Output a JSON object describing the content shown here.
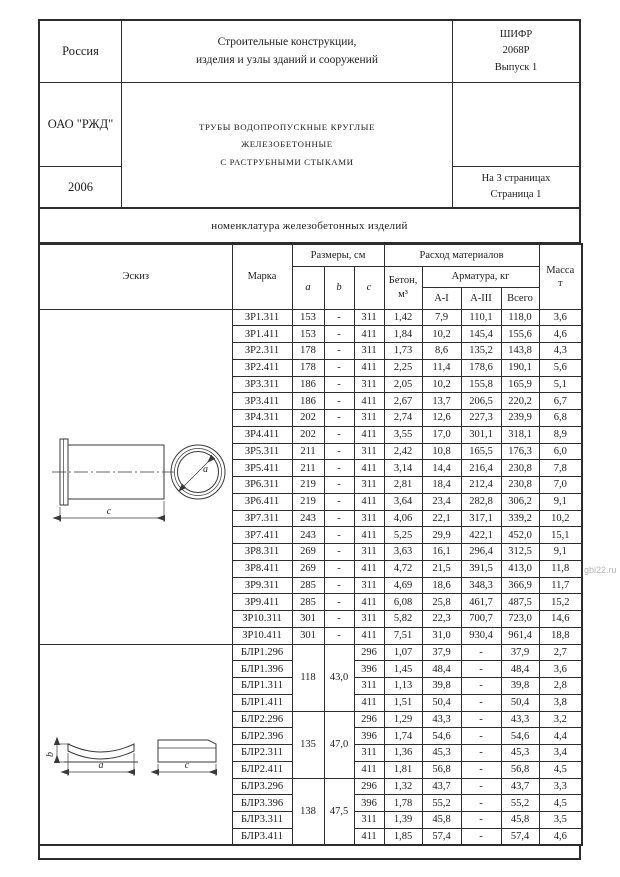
{
  "header": {
    "country": "Россия",
    "series_title_line1": "Строительные конструкции,",
    "series_title_line2": "изделия и узлы зданий и сооружений",
    "cipher_line1": "ШИФР",
    "cipher_line2": "2068Р",
    "cipher_line3": "Выпуск 1",
    "org": "ОАО \"РЖД\"",
    "doc_title_line1": "ТРУБЫ ВОДОПРОПУСКНЫЕ КРУГЛЫЕ",
    "doc_title_line2": "ЖЕЛЕЗОБЕТОННЫЕ",
    "doc_title_line3": "С РАСТРУБНЫМИ СТЫКАМИ",
    "year": "2006",
    "pages_line1": "На 3 страницах",
    "pages_line2": "Страница 1"
  },
  "section_title": "номенклатура железобетонных изделий",
  "table": {
    "headers": {
      "sketch": "Эскиз",
      "mark": "Марка",
      "dims": "Размеры, см",
      "dim_a": "a",
      "dim_b": "b",
      "dim_c": "c",
      "materials": "Расход материалов",
      "concrete_line1": "Бетон,",
      "concrete_line2": "м³",
      "rebar": "Арматура, кг",
      "a1": "А-I",
      "a3": "А-III",
      "total": "Всего",
      "mass_line1": "Масса",
      "mass_line2": "т"
    },
    "zr_rows": [
      {
        "mark": "ЗР1.311",
        "a": "153",
        "b": "-",
        "c": "311",
        "concrete": "1,42",
        "a1": "7,9",
        "a3": "110,1",
        "total": "118,0",
        "mass": "3,6"
      },
      {
        "mark": "ЗР1.411",
        "a": "153",
        "b": "-",
        "c": "411",
        "concrete": "1,84",
        "a1": "10,2",
        "a3": "145,4",
        "total": "155,6",
        "mass": "4,6"
      },
      {
        "mark": "ЗР2.311",
        "a": "178",
        "b": "-",
        "c": "311",
        "concrete": "1,73",
        "a1": "8,6",
        "a3": "135,2",
        "total": "143,8",
        "mass": "4,3"
      },
      {
        "mark": "ЗР2.411",
        "a": "178",
        "b": "-",
        "c": "411",
        "concrete": "2,25",
        "a1": "11,4",
        "a3": "178,6",
        "total": "190,1",
        "mass": "5,6"
      },
      {
        "mark": "ЗР3.311",
        "a": "186",
        "b": "-",
        "c": "311",
        "concrete": "2,05",
        "a1": "10,2",
        "a3": "155,8",
        "total": "165,9",
        "mass": "5,1"
      },
      {
        "mark": "ЗР3.411",
        "a": "186",
        "b": "-",
        "c": "411",
        "concrete": "2,67",
        "a1": "13,7",
        "a3": "206,5",
        "total": "220,2",
        "mass": "6,7"
      },
      {
        "mark": "ЗР4.311",
        "a": "202",
        "b": "-",
        "c": "311",
        "concrete": "2,74",
        "a1": "12,6",
        "a3": "227,3",
        "total": "239,9",
        "mass": "6,8"
      },
      {
        "mark": "ЗР4.411",
        "a": "202",
        "b": "-",
        "c": "411",
        "concrete": "3,55",
        "a1": "17,0",
        "a3": "301,1",
        "total": "318,1",
        "mass": "8,9"
      },
      {
        "mark": "ЗР5.311",
        "a": "211",
        "b": "-",
        "c": "311",
        "concrete": "2,42",
        "a1": "10,8",
        "a3": "165,5",
        "total": "176,3",
        "mass": "6,0"
      },
      {
        "mark": "ЗР5.411",
        "a": "211",
        "b": "-",
        "c": "411",
        "concrete": "3,14",
        "a1": "14,4",
        "a3": "216,4",
        "total": "230,8",
        "mass": "7,8"
      },
      {
        "mark": "ЗР6.311",
        "a": "219",
        "b": "-",
        "c": "311",
        "concrete": "2,81",
        "a1": "18,4",
        "a3": "212,4",
        "total": "230,8",
        "mass": "7,0"
      },
      {
        "mark": "ЗР6.411",
        "a": "219",
        "b": "-",
        "c": "411",
        "concrete": "3,64",
        "a1": "23,4",
        "a3": "282,8",
        "total": "306,2",
        "mass": "9,1"
      },
      {
        "mark": "ЗР7.311",
        "a": "243",
        "b": "-",
        "c": "311",
        "concrete": "4,06",
        "a1": "22,1",
        "a3": "317,1",
        "total": "339,2",
        "mass": "10,2"
      },
      {
        "mark": "ЗР7.411",
        "a": "243",
        "b": "-",
        "c": "411",
        "concrete": "5,25",
        "a1": "29,9",
        "a3": "422,1",
        "total": "452,0",
        "mass": "15,1"
      },
      {
        "mark": "ЗР8.311",
        "a": "269",
        "b": "-",
        "c": "311",
        "concrete": "3,63",
        "a1": "16,1",
        "a3": "296,4",
        "total": "312,5",
        "mass": "9,1"
      },
      {
        "mark": "ЗР8.411",
        "a": "269",
        "b": "-",
        "c": "411",
        "concrete": "4,72",
        "a1": "21,5",
        "a3": "391,5",
        "total": "413,0",
        "mass": "11,8"
      },
      {
        "mark": "ЗР9.311",
        "a": "285",
        "b": "-",
        "c": "311",
        "concrete": "4,69",
        "a1": "18,6",
        "a3": "348,3",
        "total": "366,9",
        "mass": "11,7"
      },
      {
        "mark": "ЗР9.411",
        "a": "285",
        "b": "-",
        "c": "411",
        "concrete": "6,08",
        "a1": "25,8",
        "a3": "461,7",
        "total": "487,5",
        "mass": "15,2"
      },
      {
        "mark": "ЗР10.311",
        "a": "301",
        "b": "-",
        "c": "311",
        "concrete": "5,82",
        "a1": "22,3",
        "a3": "700,7",
        "total": "723,0",
        "mass": "14,6"
      },
      {
        "mark": "ЗР10.411",
        "a": "301",
        "b": "-",
        "c": "411",
        "concrete": "7,51",
        "a1": "31,0",
        "a3": "930,4",
        "total": "961,4",
        "mass": "18,8"
      }
    ],
    "blr_groups": [
      {
        "a": "118",
        "b": "43,0",
        "rows": [
          {
            "mark": "БЛР1.296",
            "c": "296",
            "concrete": "1,07",
            "a1": "37,9",
            "a3": "-",
            "total": "37,9",
            "mass": "2,7"
          },
          {
            "mark": "БЛР1.396",
            "c": "396",
            "concrete": "1,45",
            "a1": "48,4",
            "a3": "-",
            "total": "48,4",
            "mass": "3,6"
          },
          {
            "mark": "БЛР1.311",
            "c": "311",
            "concrete": "1,13",
            "a1": "39,8",
            "a3": "-",
            "total": "39,8",
            "mass": "2,8"
          },
          {
            "mark": "БЛР1.411",
            "c": "411",
            "concrete": "1,51",
            "a1": "50,4",
            "a3": "-",
            "total": "50,4",
            "mass": "3,8"
          }
        ]
      },
      {
        "a": "135",
        "b": "47,0",
        "rows": [
          {
            "mark": "БЛР2.296",
            "c": "296",
            "concrete": "1,29",
            "a1": "43,3",
            "a3": "-",
            "total": "43,3",
            "mass": "3,2"
          },
          {
            "mark": "БЛР2.396",
            "c": "396",
            "concrete": "1,74",
            "a1": "54,6",
            "a3": "-",
            "total": "54,6",
            "mass": "4,4"
          },
          {
            "mark": "БЛР2.311",
            "c": "311",
            "concrete": "1,36",
            "a1": "45,3",
            "a3": "-",
            "total": "45,3",
            "mass": "3,4"
          },
          {
            "mark": "БЛР2.411",
            "c": "411",
            "concrete": "1,81",
            "a1": "56,8",
            "a3": "-",
            "total": "56,8",
            "mass": "4,5"
          }
        ]
      },
      {
        "a": "138",
        "b": "47,5",
        "rows": [
          {
            "mark": "БЛР3.296",
            "c": "296",
            "concrete": "1,32",
            "a1": "43,7",
            "a3": "-",
            "total": "43,7",
            "mass": "3,3"
          },
          {
            "mark": "БЛР3.396",
            "c": "396",
            "concrete": "1,78",
            "a1": "55,2",
            "a3": "-",
            "total": "55,2",
            "mass": "4,5"
          },
          {
            "mark": "БЛР3.311",
            "c": "311",
            "concrete": "1,39",
            "a1": "45,8",
            "a3": "-",
            "total": "45,8",
            "mass": "3,5"
          },
          {
            "mark": "БЛР3.411",
            "c": "411",
            "concrete": "1,85",
            "a1": "57,4",
            "a3": "-",
            "total": "57,4",
            "mass": "4,6"
          }
        ]
      }
    ]
  },
  "sketch_labels": {
    "pipe_c": "c",
    "pipe_a": "a",
    "saddle_b": "b",
    "saddle_a": "a",
    "saddle_c": "c"
  },
  "watermark": "gbi22.ru"
}
